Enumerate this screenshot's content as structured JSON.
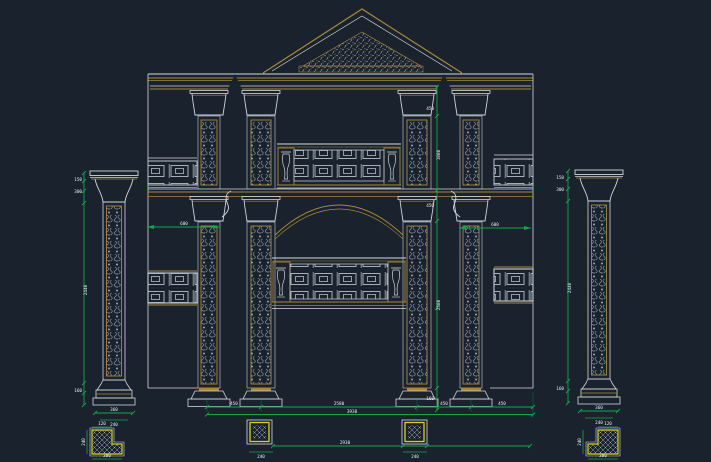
{
  "viewport": {
    "kind": "cad-model-space"
  },
  "palette": {
    "background": "#1a222e",
    "gold": "#a8893a",
    "line_white": "#d3dae1",
    "line_muted": "#97a2ae",
    "dim_green": "#16a54a",
    "detail_yellow": "#d9d21f"
  },
  "dims": {
    "left_pillar": {
      "seg1": "150",
      "seg2": "300",
      "shaft": "2440",
      "base": "160",
      "width": "360",
      "plinth": "240"
    },
    "left_section": {
      "top": "120",
      "side": "240",
      "bottom": "300"
    },
    "right_pillar": {
      "seg1": "150",
      "seg2": "300",
      "shaft": "2440",
      "base": "160",
      "width": "360",
      "plinth": "240"
    },
    "right_section": {
      "top": "120",
      "side": "240",
      "bottom": "300"
    },
    "facade": {
      "bay_left": "600",
      "bay_right": "600",
      "v_top": "450",
      "v_upper": "1080",
      "v_mid": "450",
      "v_lower": "2580",
      "v_base": "160",
      "b_seg1": "450",
      "b_seg2": "2580",
      "b_seg3": "450",
      "b_seg4": "450",
      "b_total": "3930",
      "b_span": "2930",
      "b_col_left": "240",
      "b_col_right": "240"
    }
  }
}
